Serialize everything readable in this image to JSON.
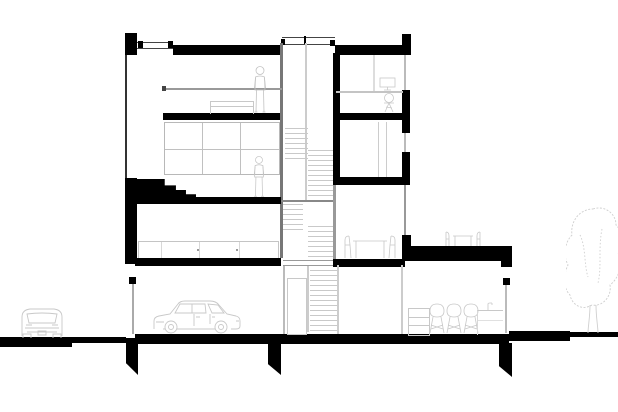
{
  "meta": {
    "description": "Black-and-white architectural cross-section drawing of a four-level split-section townhouse with street-level garage, central switchback stair, rear terrace, garden tree, two parked cars and two human figures",
    "visible_text": []
  },
  "colors": {
    "background": "#ffffff",
    "ink": "#000000",
    "wall_gray": "#777777",
    "line_gray": "#aaaaaa",
    "tread_gray": "#c9c9c9",
    "furniture_gray": "#c8c8c8",
    "figure_gray": "#c2c2c2"
  },
  "scene": {
    "site_objects": [
      "street-car",
      "street-pavement",
      "garden-ground",
      "garden-tree",
      "foundation-piers"
    ],
    "shell_objects": [
      "left-parapet",
      "roof-skylight",
      "roof-slab-left",
      "stair-skylight",
      "roof-slab-right",
      "right-parapet",
      "facade-glazing",
      "facade-windows"
    ],
    "interior_objects": [
      "mezzanine-bed",
      "person-top-floor",
      "window-grid-wall",
      "person-middle-floor",
      "switchback-stair",
      "kitchen-counter",
      "study-desk",
      "study-monitor",
      "study-chair",
      "bedroom-door",
      "dining-table-set",
      "terrace-dining-set",
      "garage-car",
      "basement-door",
      "kitchen-cabinet",
      "bar-stools",
      "basement-counter-with-faucet"
    ],
    "counts": {
      "people": 2,
      "cars": 2,
      "trees": 1,
      "foundation_piers": 3
    }
  }
}
